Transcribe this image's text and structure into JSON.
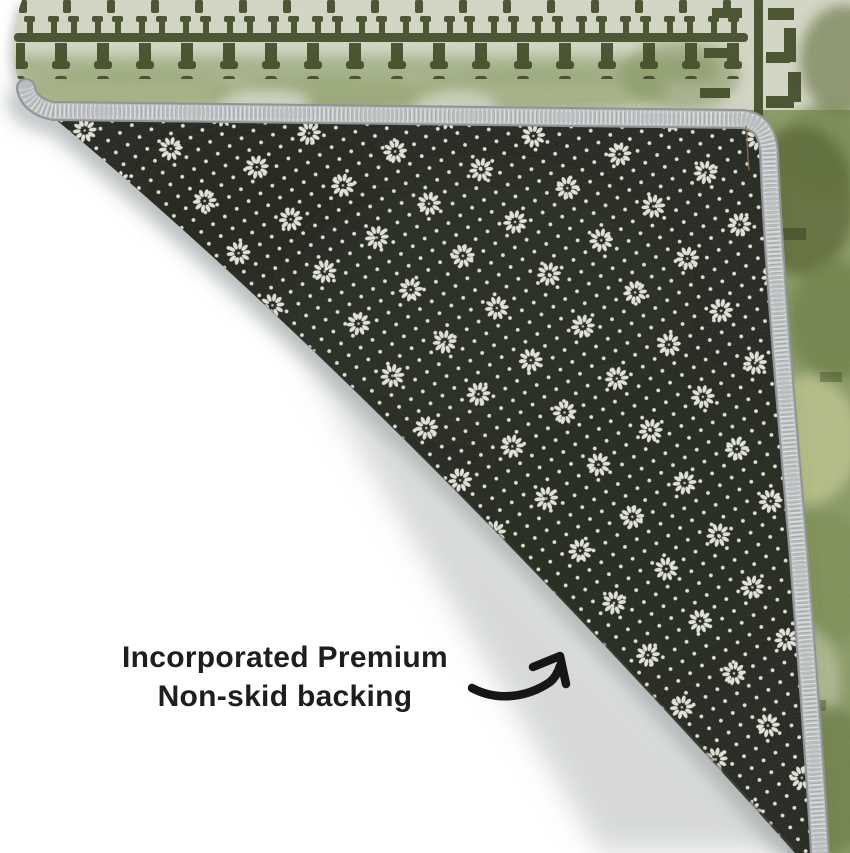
{
  "canvas": {
    "width": 850,
    "height": 853,
    "background_color": "#ffffff"
  },
  "caption": {
    "line1": "Incorporated Premium",
    "line2": "Non-skid backing",
    "color": "#1e1e1e"
  },
  "arrow": {
    "color": "#161616"
  },
  "rug": {
    "face_base_color": "#d9dcc9",
    "face_pattern_color": "#3d4720",
    "face_accent_color": "#8a9c64",
    "binding_color": "#b8bcbd",
    "backing_color": "#1b1d16",
    "backing_dot_color": "#e8e7de"
  }
}
